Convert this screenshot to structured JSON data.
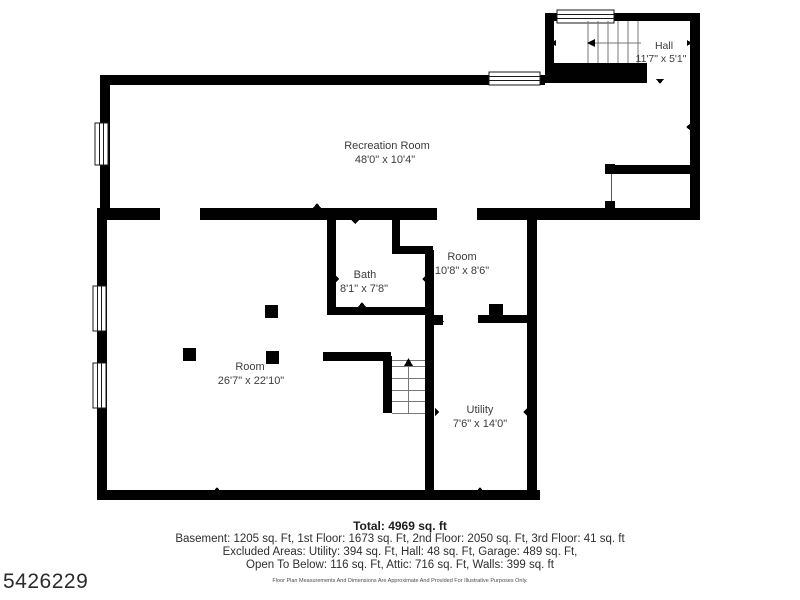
{
  "plan": {
    "rooms": [
      {
        "name": "Hall",
        "dims": "11'7\" x 5'1\""
      },
      {
        "name": "Recreation Room",
        "dims": "48'0\" x 10'4\""
      },
      {
        "name": "Bath",
        "dims": "8'1\" x 7'8\""
      },
      {
        "name": "Room",
        "dims": "10'8\" x 8'6\""
      },
      {
        "name": "Room",
        "dims": "26'7\" x 22'10\""
      },
      {
        "name": "Utility",
        "dims": "7'6\" x 14'0\""
      }
    ]
  },
  "summary": {
    "total": "Total: 4969 sq. ft",
    "line1": "Basement: 1205 sq. Ft, 1st Floor: 1673 sq. Ft, 2nd Floor: 2050 sq. Ft, 3rd Floor: 41 sq. ft",
    "line2": "Excluded Areas: Utility: 394 sq. Ft, Hall: 48 sq. Ft, Garage: 489 sq. Ft,",
    "line3": "Open To Below: 116 sq. Ft, Attic: 716 sq. Ft, Walls: 399 sq. ft",
    "disclaimer": "Floor Plan Measurements And Dimensions Are Approximate And Provided For Illustrative Purposes Only."
  },
  "watermark": {
    "id": "5426229"
  },
  "colors": {
    "wall": "#010101",
    "text": "#3c3c3c"
  }
}
